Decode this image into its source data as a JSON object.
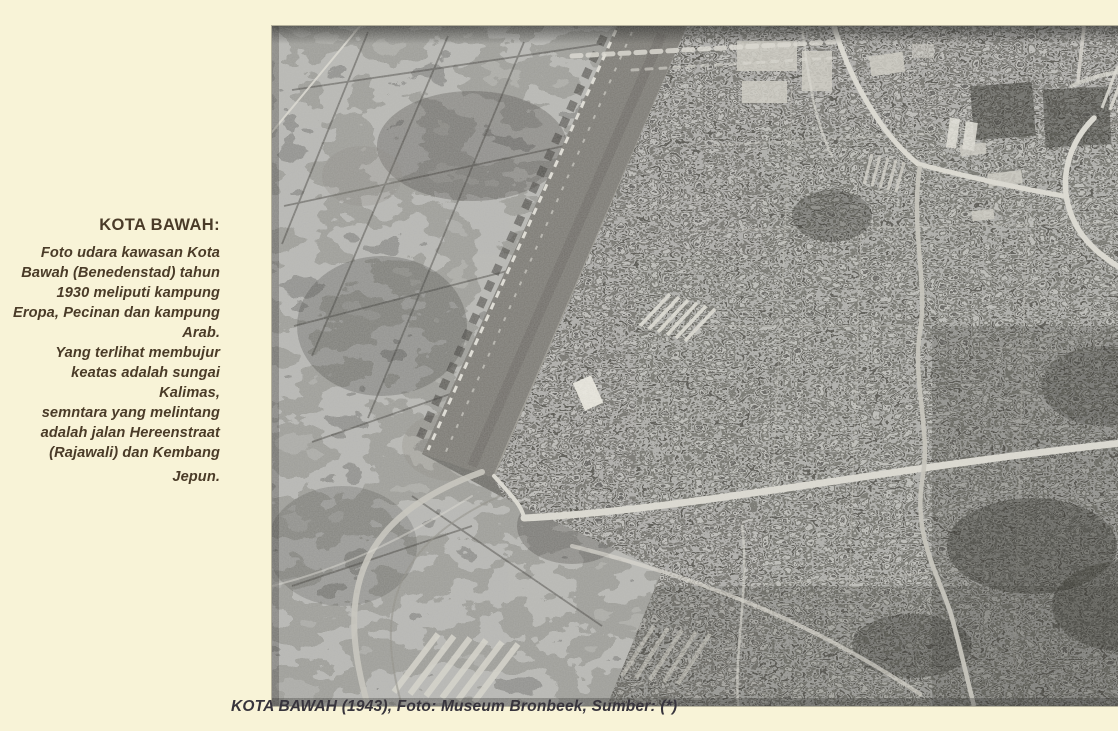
{
  "colors": {
    "page-bg": "#f8f3d7",
    "sidebar-text": "#4a3b28",
    "caption-text": "#37343c",
    "photo-base": "#6f6e69"
  },
  "sidebar": {
    "title": "KOTA BAWAH:",
    "lines": [
      "Foto udara kawasan Kota",
      "Bawah (Benedenstad) tahun",
      "1930 meliputi kampung",
      "Eropa, Pecinan dan kampung",
      "Arab.",
      "Yang terlihat membujur",
      "keatas adalah sungai Kalimas,",
      "semntara yang melintang",
      "adalah jalan Hereenstraat",
      "(Rajawali) dan Kembang",
      "Jepun."
    ]
  },
  "caption": {
    "text": "KOTA BAWAH (1943), Foto: Museum Bronbeek, Sumber: (*)"
  }
}
